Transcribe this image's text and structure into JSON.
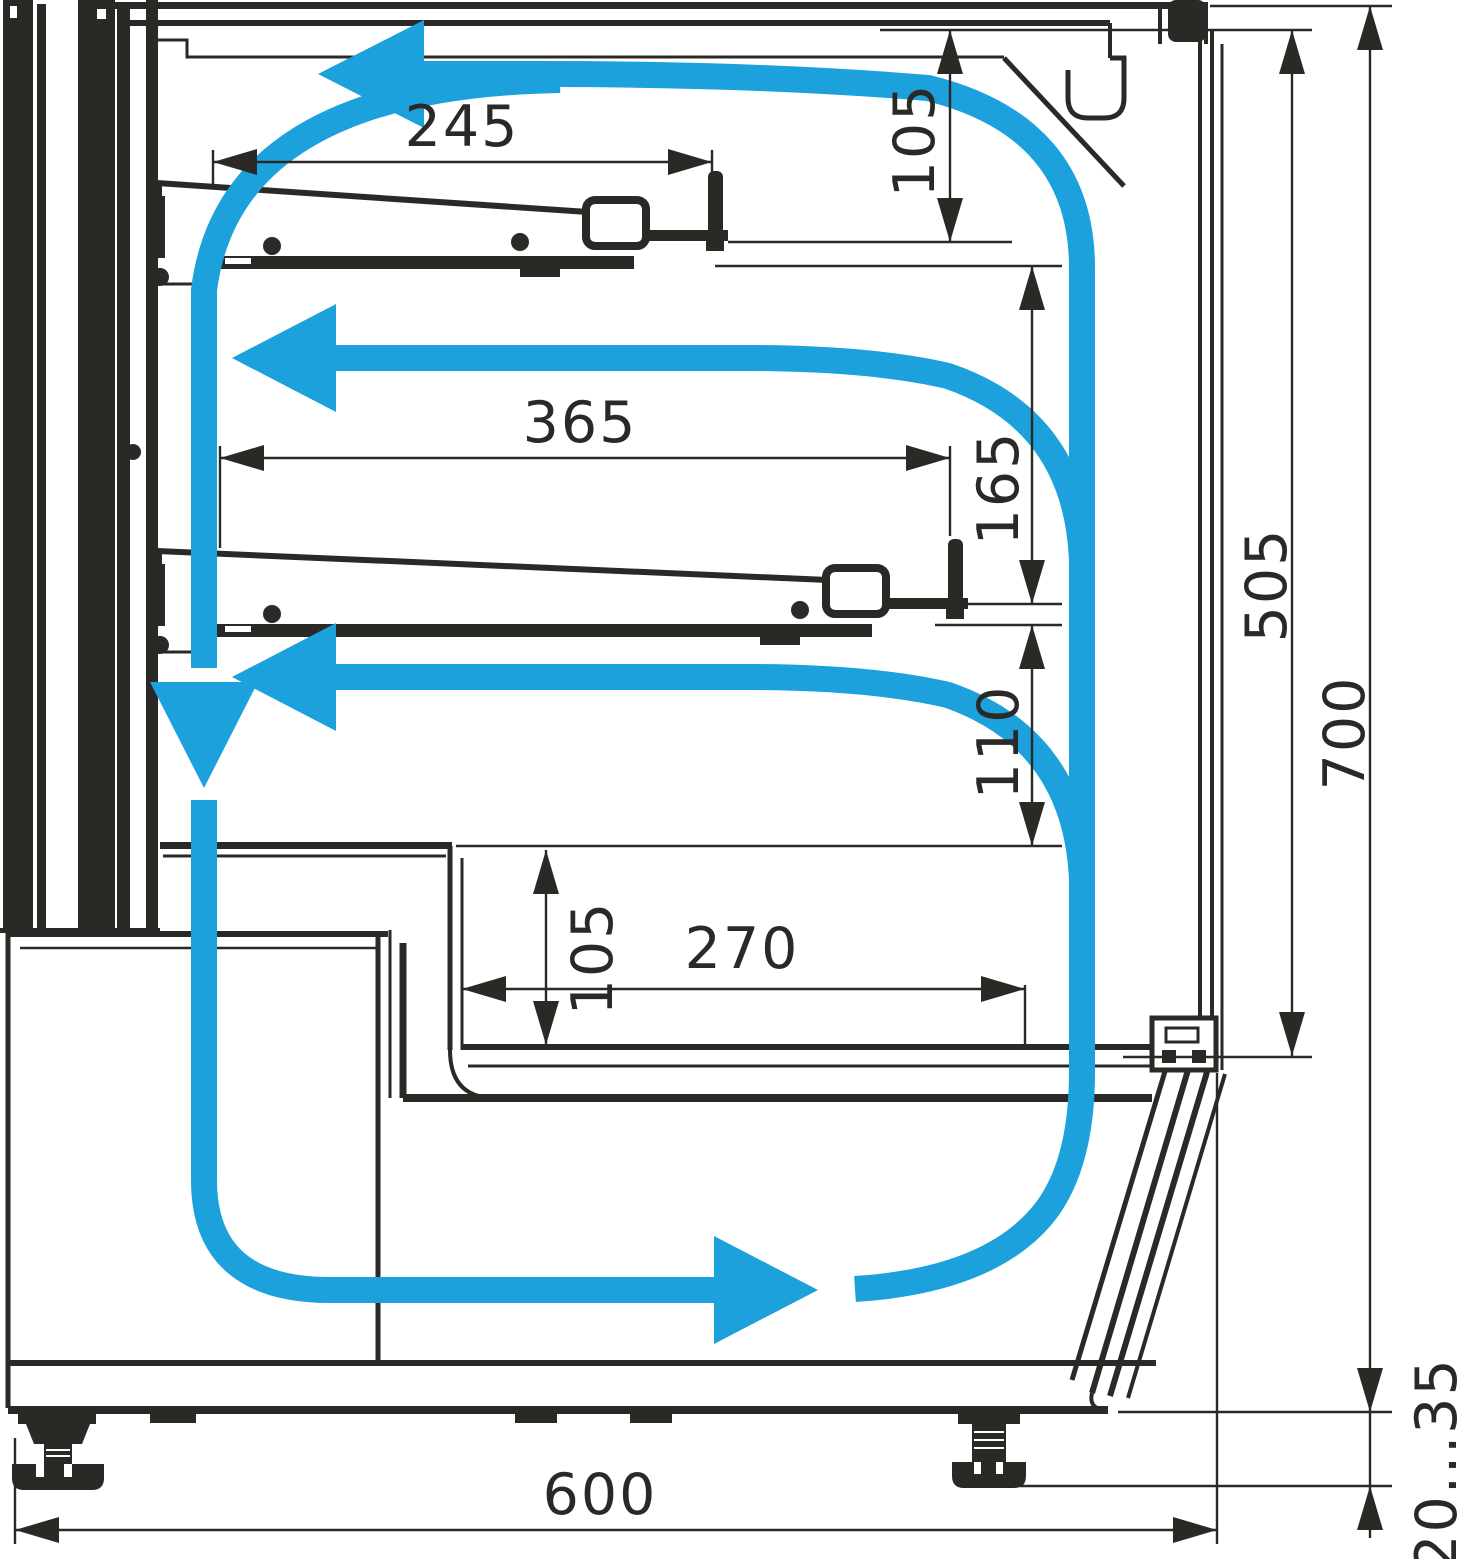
{
  "drawing": {
    "kind": "technical-cross-section",
    "subject": "refrigerated display showcase side section with air circulation loop",
    "colors": {
      "line": "#2b2926",
      "airflow": "#1da1dc",
      "background": "#ffffff"
    },
    "dimensions": {
      "upper_shelf_depth": "245",
      "canopy_to_upper_shelf": "105",
      "middle_shelf_depth": "365",
      "upper_to_middle_shelf_gap": "165",
      "middle_shelf_to_well_gap": "110",
      "well_inner_height": "105",
      "well_depth": "270",
      "front_glass_height": "505",
      "overall_height": "700",
      "overall_depth": "600",
      "foot_height_range": "20...35"
    },
    "airflow_arrows": [
      {
        "name": "top-duct-arrow",
        "direction": "left"
      },
      {
        "name": "upper-level-arrow",
        "direction": "left"
      },
      {
        "name": "middle-level-arrow",
        "direction": "left"
      },
      {
        "name": "rear-duct-arrow",
        "direction": "down"
      },
      {
        "name": "bottom-duct-arrow",
        "direction": "right"
      }
    ]
  }
}
